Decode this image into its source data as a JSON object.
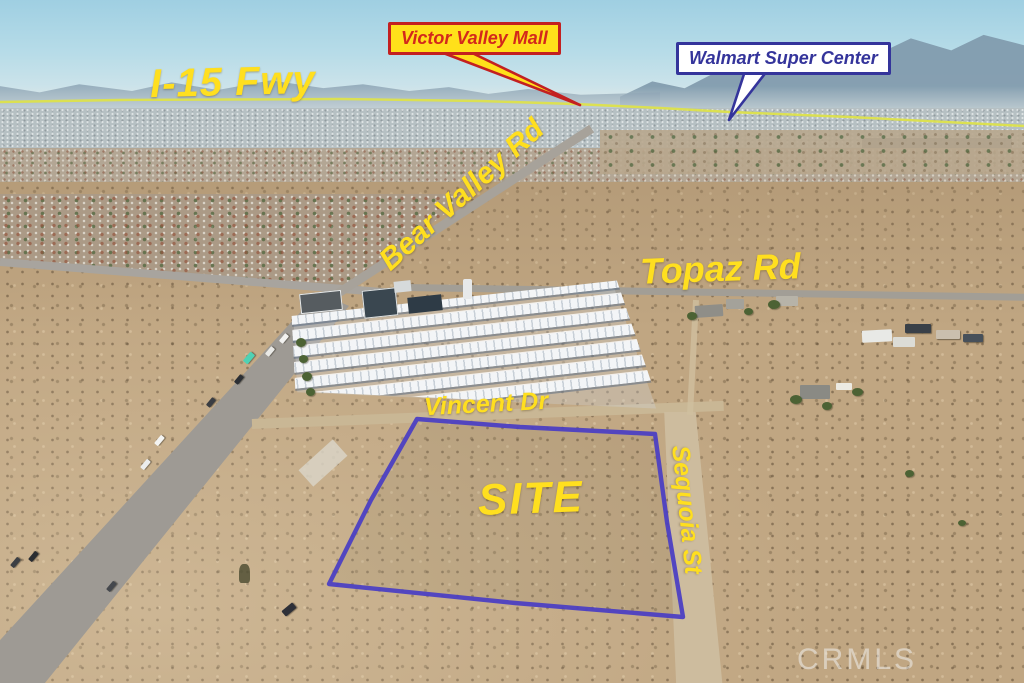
{
  "colors": {
    "label-yellow": "#ffdf1f",
    "fwy-line-yellow": "#dde14b",
    "callout-box-yellow": "#ffe01a",
    "callout-red-text": "#d3281c",
    "callout-red-border": "#c32020",
    "callout-navy": "#34349b",
    "callout-white-bg": "#ffffff",
    "site-outline-blue": "#4a3ec4",
    "watermark-white": "#f0f0ee"
  },
  "callouts": {
    "victor_valley_mall": "Victor Valley Mall",
    "walmart_super_center": "Walmart Super Center"
  },
  "labels": {
    "i15_fwy": "I-15 Fwy",
    "bear_valley_rd": "Bear Valley Rd",
    "topaz_rd": "Topaz Rd",
    "vincent_dr": "Vincent Dr",
    "sequoia_st": "Sequoia St",
    "site": "SITE"
  },
  "watermark": "CRMLS"
}
